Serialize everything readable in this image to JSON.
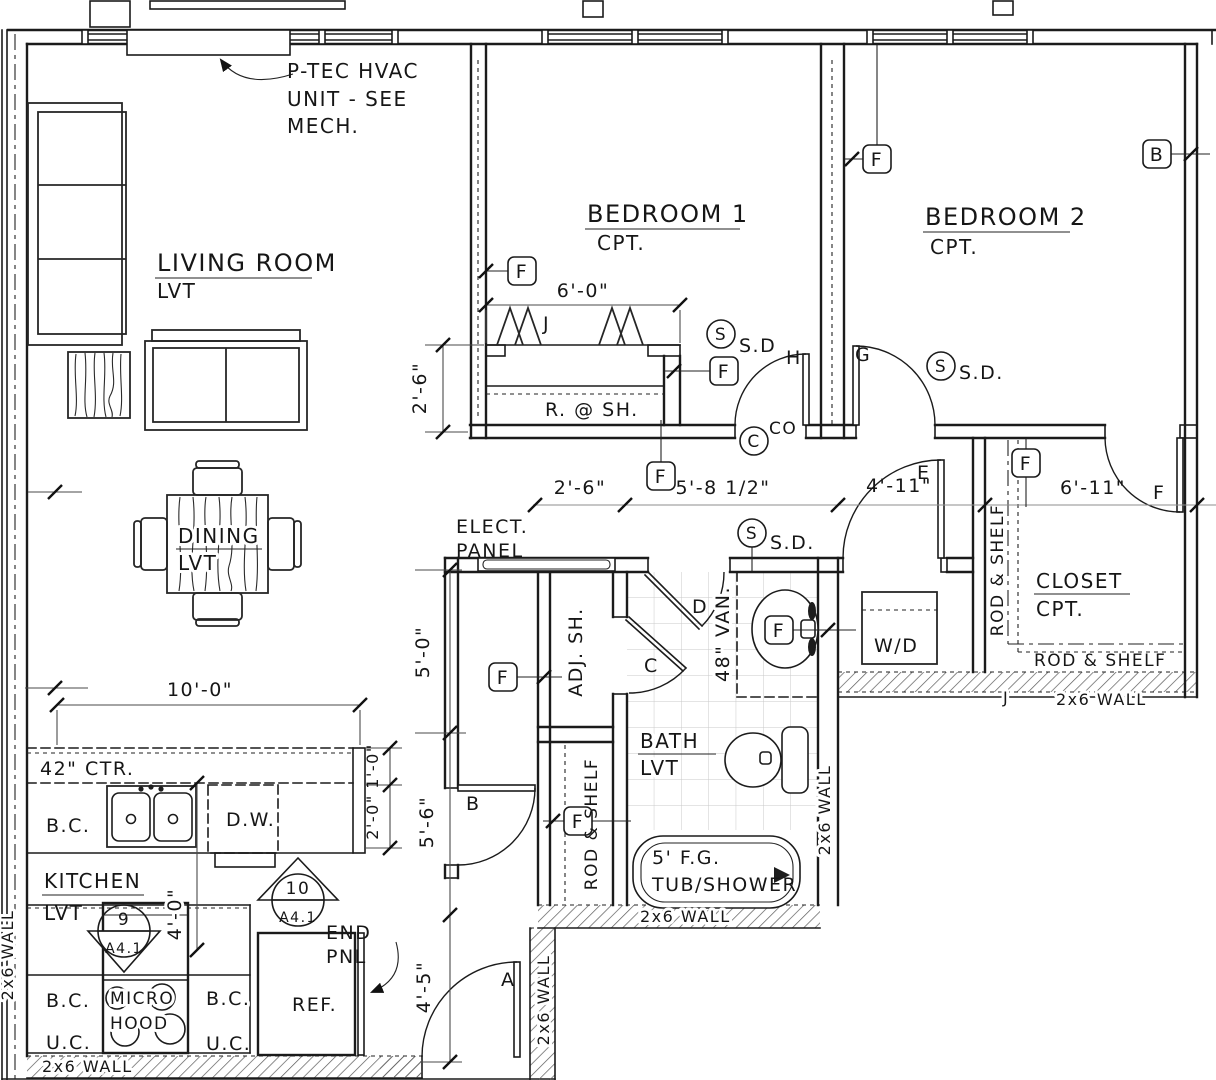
{
  "rooms": {
    "living": {
      "name": "LIVING ROOM",
      "floor": "LVT"
    },
    "dining": {
      "name": "DINING",
      "floor": "LVT"
    },
    "kitchen": {
      "name": "KITCHEN",
      "floor": "LVT"
    },
    "bedroom1": {
      "name": "BEDROOM 1",
      "floor": "CPT."
    },
    "bedroom2": {
      "name": "BEDROOM 2",
      "floor": "CPT."
    },
    "bath": {
      "name": "BATH",
      "floor": "LVT"
    },
    "closet": {
      "name": "CLOSET",
      "floor": "CPT."
    }
  },
  "notes": {
    "hvac": {
      "l1": "P-TEC HVAC",
      "l2": "UNIT - SEE",
      "l3": "MECH."
    },
    "elect": {
      "l1": "ELECT.",
      "l2": "PANEL"
    },
    "end_panel": {
      "l1": "END",
      "l2": "PNL"
    }
  },
  "labels": {
    "ctr42": "42\" CTR.",
    "bc": "B.C.",
    "uc": "U.C.",
    "dw": "D.W.",
    "micro": "MICRO",
    "hood": "HOOD",
    "ref": "REF.",
    "wd": "W/D",
    "adj_sh": "ADJ. SH.",
    "van48": "48\" VAN.",
    "rod_shelf": "ROD & SHELF",
    "r_at_sh": "R. @ SH.",
    "tub_l1": "5' F.G.",
    "tub_l2": "TUB/SHOWER",
    "wall2x6": "2x6 WALL"
  },
  "dims": {
    "d6_0": "6'-0\"",
    "d2_6": "2'-6\"",
    "d5_8h": "5'-8 1/2\"",
    "d4_11": "4'-11\"",
    "d6_11": "6'-11\"",
    "d5_0": "5'-0\"",
    "d5_6": "5'-6\"",
    "d4_5": "4'-5\"",
    "d10_0": "10'-0\"",
    "d1_0": "1'-0\"",
    "d2_0": "2'-0\"",
    "d4_0": "4'-0\""
  },
  "tags": {
    "f": "F",
    "b": "B",
    "s": "S",
    "c": "C",
    "sd": "S.D.",
    "sd_short": "S.D",
    "co": "CO"
  },
  "doors": {
    "a": "A",
    "b": "B",
    "c": "C",
    "d": "D",
    "e": "E",
    "f": "F",
    "g": "G",
    "h": "H",
    "j": "J"
  },
  "details": {
    "m9": {
      "num": "9",
      "sheet": "A4.1"
    },
    "m10": {
      "num": "10",
      "sheet": "A4.1"
    }
  },
  "colors": {
    "line": "#1b1b1b",
    "tile_grid": "#c9c9c9",
    "dim": "#4a4a4a",
    "paper": "#ffffff"
  }
}
